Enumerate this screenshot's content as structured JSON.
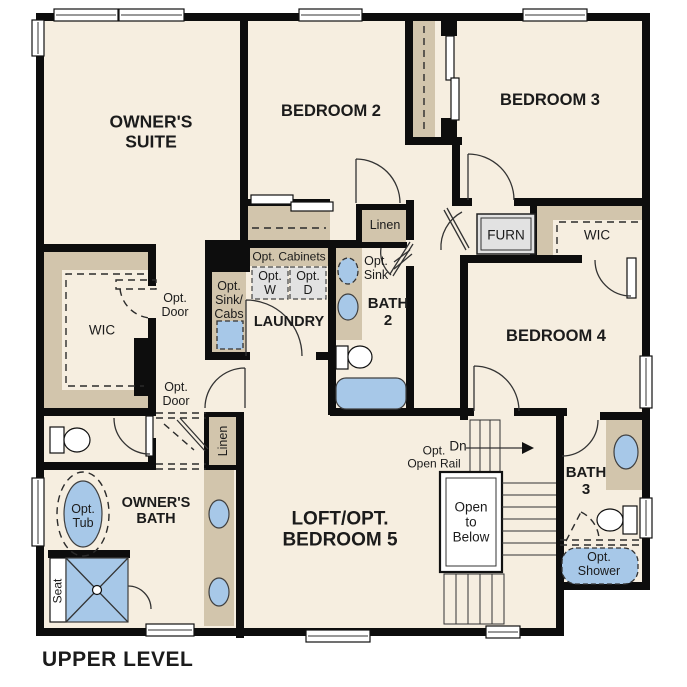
{
  "title": "UPPER LEVEL",
  "colors": {
    "wall": "#0d0d0d",
    "floor": "#f6eee0",
    "cabinet": "#d2c5ac",
    "fixture": "#a7c8e8",
    "appliance": "#e2e2e2"
  },
  "labels": {
    "owners_suite": "OWNER'S\nSUITE",
    "bedroom2": "BEDROOM 2",
    "bedroom3": "BEDROOM 3",
    "bedroom4": "BEDROOM 4",
    "loft": "LOFT/OPT.\nBEDROOM 5",
    "owners_bath": "OWNER'S\nBATH",
    "bath2": "BATH\n2",
    "bath3": "BATH\n3",
    "laundry": "LAUNDRY",
    "wic_left": "WIC",
    "wic_right": "WIC",
    "linen_hall": "Linen",
    "linen_bath": "Linen",
    "furnace": "FURN",
    "opt_cabinets": "Opt. Cabinets",
    "opt_washer": "Opt.\nW",
    "opt_dryer": "Opt.\nD",
    "opt_sink_cabs": "Opt.\nSink/\nCabs",
    "opt_sink": "Opt.\nSink",
    "opt_door_wic": "Opt.\nDoor",
    "opt_door_hall": "Opt.\nDoor",
    "opt_tub": "Opt.\nTub",
    "seat": "Seat",
    "opt_shower": "Opt.\nShower",
    "stairs_dn": "Dn",
    "opt_open_rail": "Opt.\nOpen Rail",
    "open_to_below": "Open\nto\nBelow"
  }
}
